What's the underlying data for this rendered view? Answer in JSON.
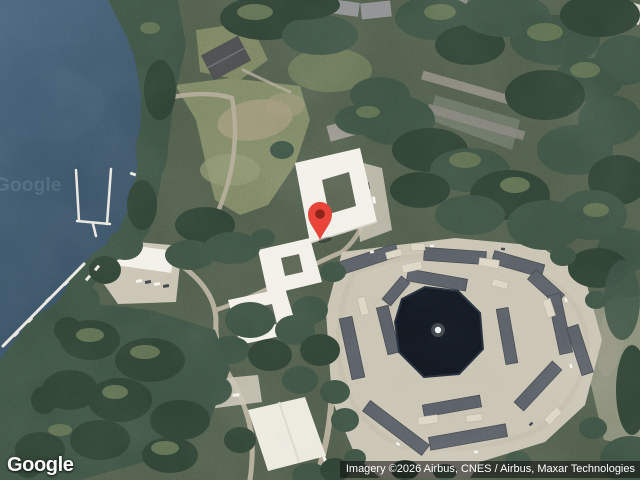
{
  "map": {
    "view_type": "satellite",
    "logo_text": "Google",
    "watermark_text": "Google",
    "attribution_text": "Imagery ©2026 Airbus, CNES / Airbus, Maxar Technologies",
    "marker": {
      "x": 320,
      "y": 240
    }
  },
  "colors": {
    "water": "#3B5468",
    "water_light": "#47627A",
    "land_base": "#4F5C4A",
    "forest_dark": "#3C5142",
    "forest_deep": "#2E4133",
    "canopy_light": "#5D6E50",
    "grass": "#7D8763",
    "dirt": "#A4997B",
    "road": "#B2AA97",
    "building_white": "#F2F0E8",
    "roof_gray": "#575C63",
    "roof_house": "#4A4B4D",
    "parking": "#C8C2B1",
    "garage": "#DBD5C3",
    "pond": "#12171F",
    "shore_rock": "#6F7566",
    "dock": "#E9E7DF",
    "pin": "#E8443A",
    "pin_inner": "#8C2418",
    "attribution_bg": "rgba(15,15,15,0.55)",
    "attribution_fg": "#FFFFFF"
  }
}
